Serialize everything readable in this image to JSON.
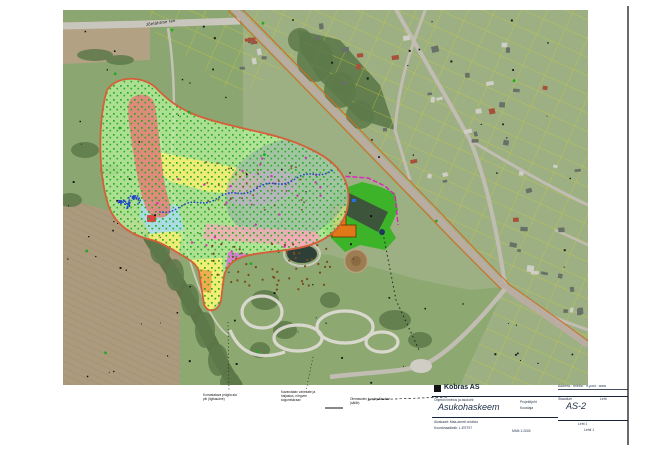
{
  "page": {
    "background": "#ffffff",
    "frame_color": "#1a1a1a"
  },
  "map": {
    "road_label": "Jõelähtme tee",
    "colors": {
      "base_residential": "#9cb083",
      "field_green": "#8ba671",
      "field_tan": "#b3a183",
      "plow_tan": "#ab9a7c",
      "plow_stripe": "#8f7f63",
      "park_green": "#8da871",
      "woods": "#5d7a4a",
      "treeline": "#556b3f",
      "road_main": "#b9aca0",
      "road_light": "#c9c6bd",
      "road_minor": "#c2bdb2",
      "track_white": "#dedbd3",
      "pond_dark": "#2e3f38",
      "pond_ring": "#ccc9c0",
      "dirt_brown": "#9c7d52",
      "dirt_inner": "#8a6a42",
      "parcel_yellow": "#d6cf2e",
      "cadastral_orange": "#d2691e",
      "blob_fill": "#b7ef9b",
      "blob_outline": "#d4603a",
      "zone_red": "#e2837a",
      "zone_yellow": "#f8ef72",
      "zone_cyan": "#a8dcec",
      "zone_gray": "#93a7ac",
      "zone_lavender": "#c9a8d4",
      "zone_pink": "#f4aab8",
      "zone_magenta": "#df6fd8",
      "zone_orange": "#f0a84e",
      "site_green": "#3db32a",
      "site_dark": "#3d4a3d",
      "building_orange": "#e07818",
      "magenta_line": "#e020c0",
      "dots_green": "#1faa1f",
      "dots_blue": "#2244cc",
      "dots_brown": "#7a4a1e",
      "dots_black": "#111111",
      "houses": [
        "#687068",
        "#cfcfc8",
        "#a8503a"
      ]
    }
  },
  "annotations": {
    "ann1": [
      "Korrastatava prügila ala",
      "piir (ligikaudne)"
    ],
    "ann2": [
      "Kavandatav vahekate ja",
      "haljastus, nõrgvee",
      "kogumiskraav"
    ],
    "ann3": [
      "Olemasolev juurdepääsutee",
      "(säilib)"
    ]
  },
  "titleblock": {
    "company": "Kobras AS",
    "top_right": "Aadress · telefon · e-post · www",
    "project_line": "Objekti nimetus ja asukoht",
    "title": "Asukohaskeem",
    "mid_line1": "Projektijuht",
    "mid_line2": "Koostaja",
    "stage_label": "Staadium",
    "sheet_label": "Leht",
    "drawing_no": "AS-2",
    "base_line1": "Aluskaart: Maa-ameti ortofoto",
    "base_line2": "Koordinaadistik: L-EST97",
    "scale": "Mõõt 1:2000",
    "sheet_value": "Leht 1",
    "sheets_value": "Lehti 1"
  }
}
